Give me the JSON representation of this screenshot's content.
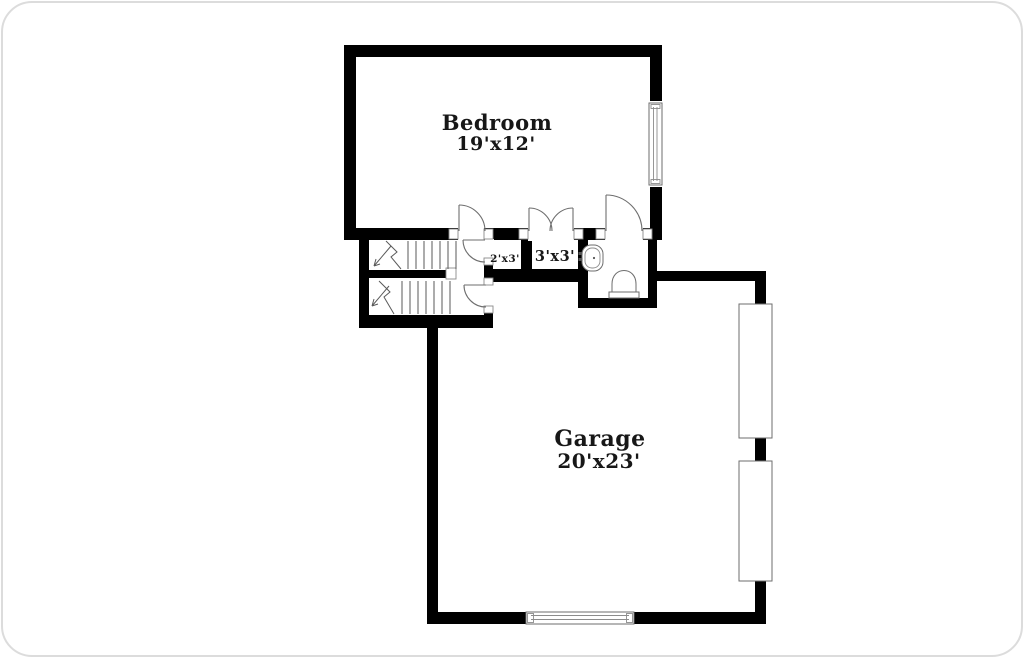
{
  "canvas": {
    "width": 1024,
    "height": 658
  },
  "colors": {
    "background": "#ffffff",
    "wall": "#000000",
    "line": "#6e6e6e",
    "text": "#171717",
    "frame": "#dcdcdc"
  },
  "rooms": {
    "bedroom": {
      "name": "Bedroom",
      "dims": "19'x12'"
    },
    "garage": {
      "name": "Garage",
      "dims": "20'x23'"
    },
    "closet_small": {
      "dims": "2'x3'"
    },
    "closet": {
      "dims": "3'x3'"
    }
  },
  "fixtures": {
    "stairs_upper": "staircase-flight-upper",
    "stairs_lower": "staircase-flight-lower",
    "sink": "bathroom-sink",
    "toilet": "toilet",
    "bedroom_window": "window",
    "garage_window": "window",
    "garage_door_1": "garage-door-panel",
    "garage_door_2": "garage-door-panel"
  }
}
